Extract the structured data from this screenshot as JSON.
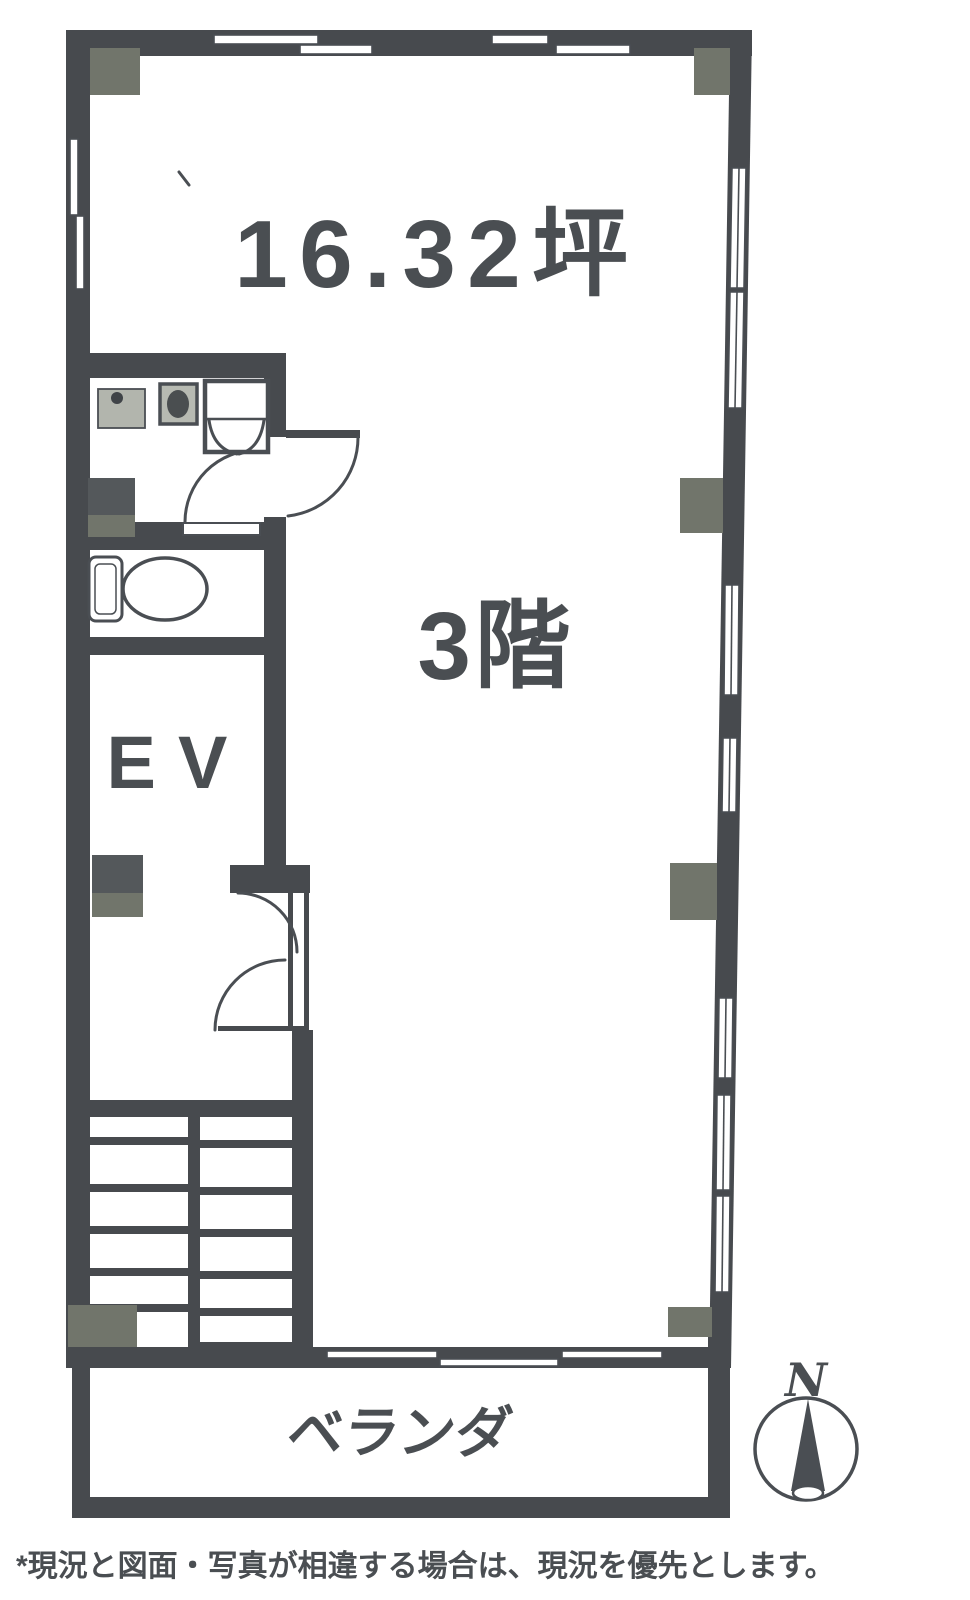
{
  "labels": {
    "area": "16.32坪",
    "floor": "3階",
    "elevator": "EV",
    "veranda": "ベランダ",
    "compass_north": "N"
  },
  "footer": {
    "note": "*現況と図面・写真が相違する場合は、現況を優先とします。"
  },
  "colors": {
    "wall": "#474a4e",
    "line": "#4a4e53",
    "pillar": "#71756b",
    "pillar_dark": "#54585b",
    "text": "#4a4e52",
    "background": "#ffffff",
    "counter_gray": "#b2b5ad"
  }
}
